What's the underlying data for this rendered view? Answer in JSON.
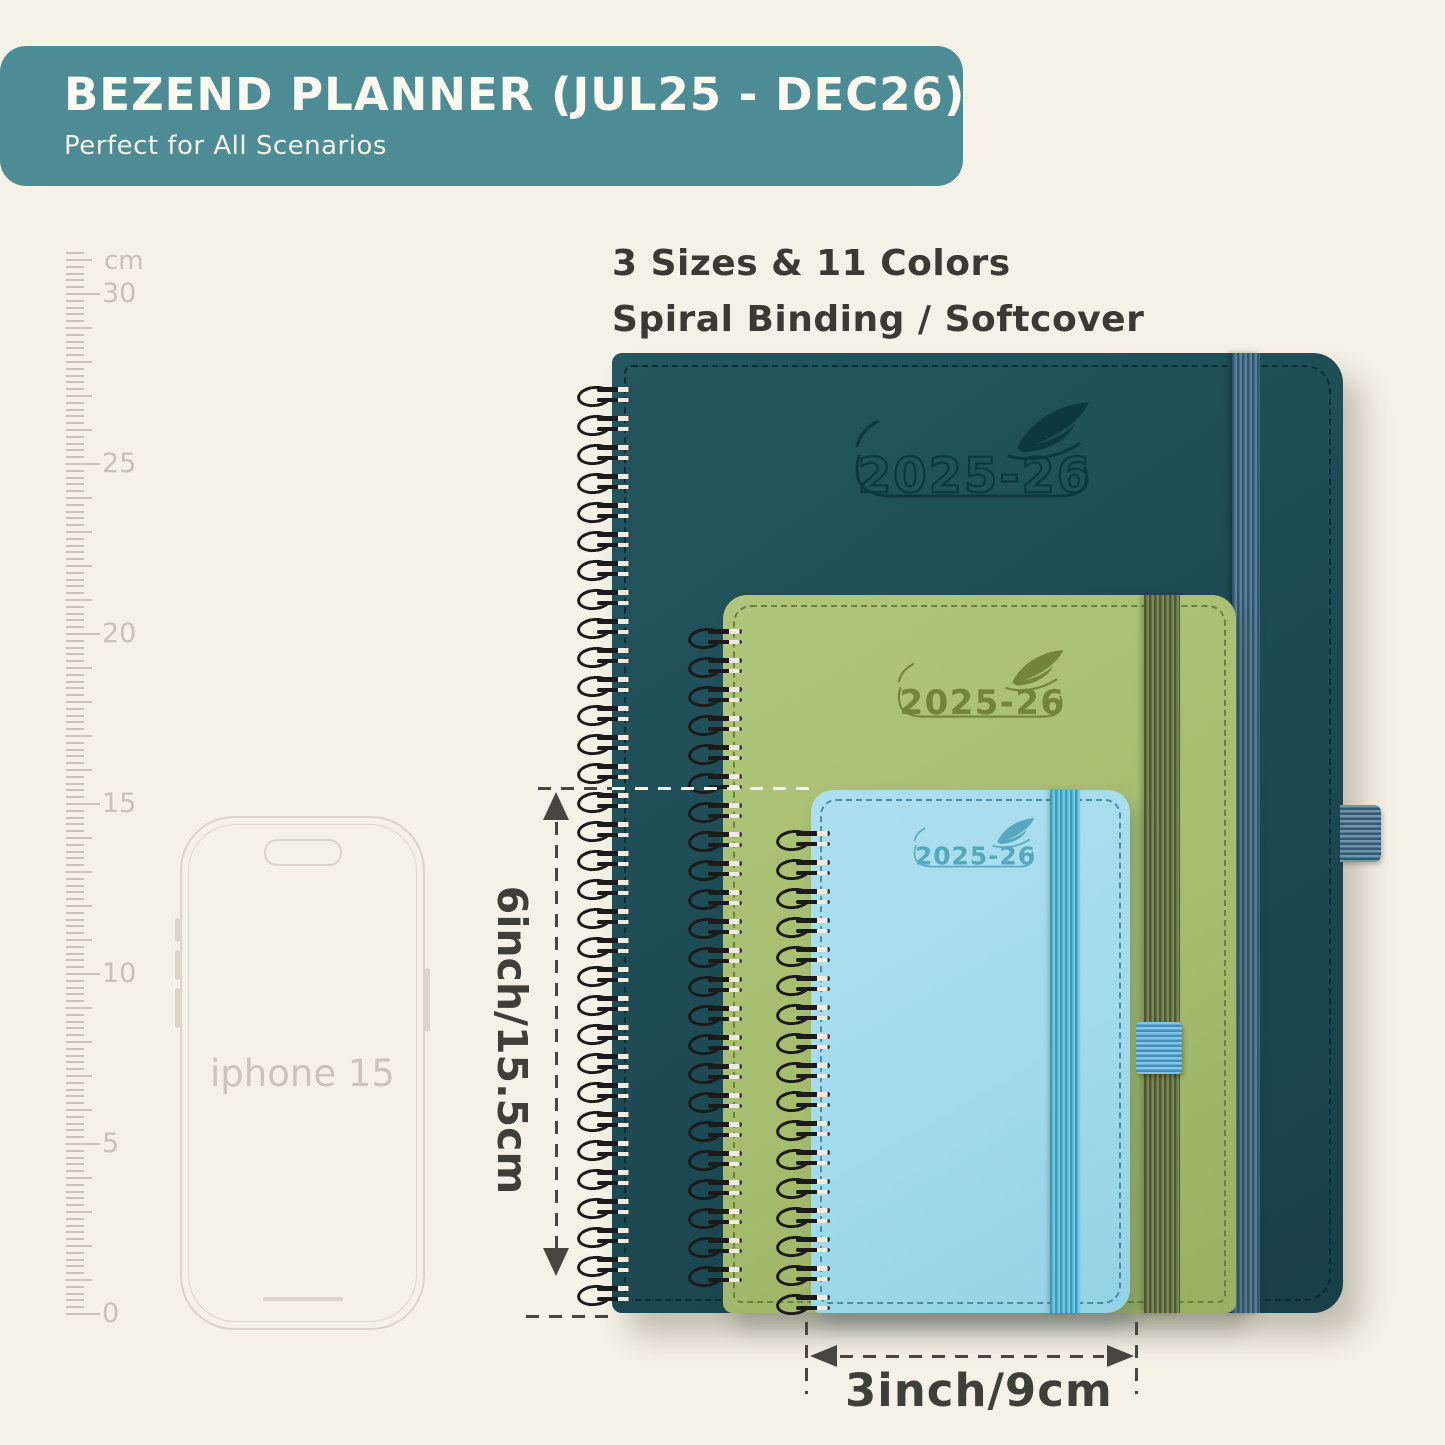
{
  "header": {
    "title": "BEZEND PLANNER (JUL25 - DEC26)",
    "subtitle": "Perfect for All Scenarios",
    "bg_color": "#4d8c94"
  },
  "intro": {
    "line1": "3 Sizes & 11 Colors",
    "line2": "Spiral Binding / Softcover"
  },
  "ruler": {
    "unit_label": "cm",
    "tick_labels": [
      "30",
      "25",
      "20",
      "15",
      "10",
      "5",
      "0"
    ]
  },
  "phone": {
    "label": "iphone 15"
  },
  "planners": [
    {
      "size": "large",
      "logo_text": "2025-26",
      "cover_color": "#1e4d56",
      "band_color": "#3f6e8c"
    },
    {
      "size": "medium",
      "logo_text": "2025-26",
      "cover_color": "#a7be71",
      "band_color": "#64743d"
    },
    {
      "size": "small",
      "logo_text": "2025-26",
      "cover_color": "#a3dbeb",
      "band_color": "#54c3e6"
    }
  ],
  "dimensions": {
    "height_label": "6inch/15.5cm",
    "width_label": "3inch/9cm"
  }
}
